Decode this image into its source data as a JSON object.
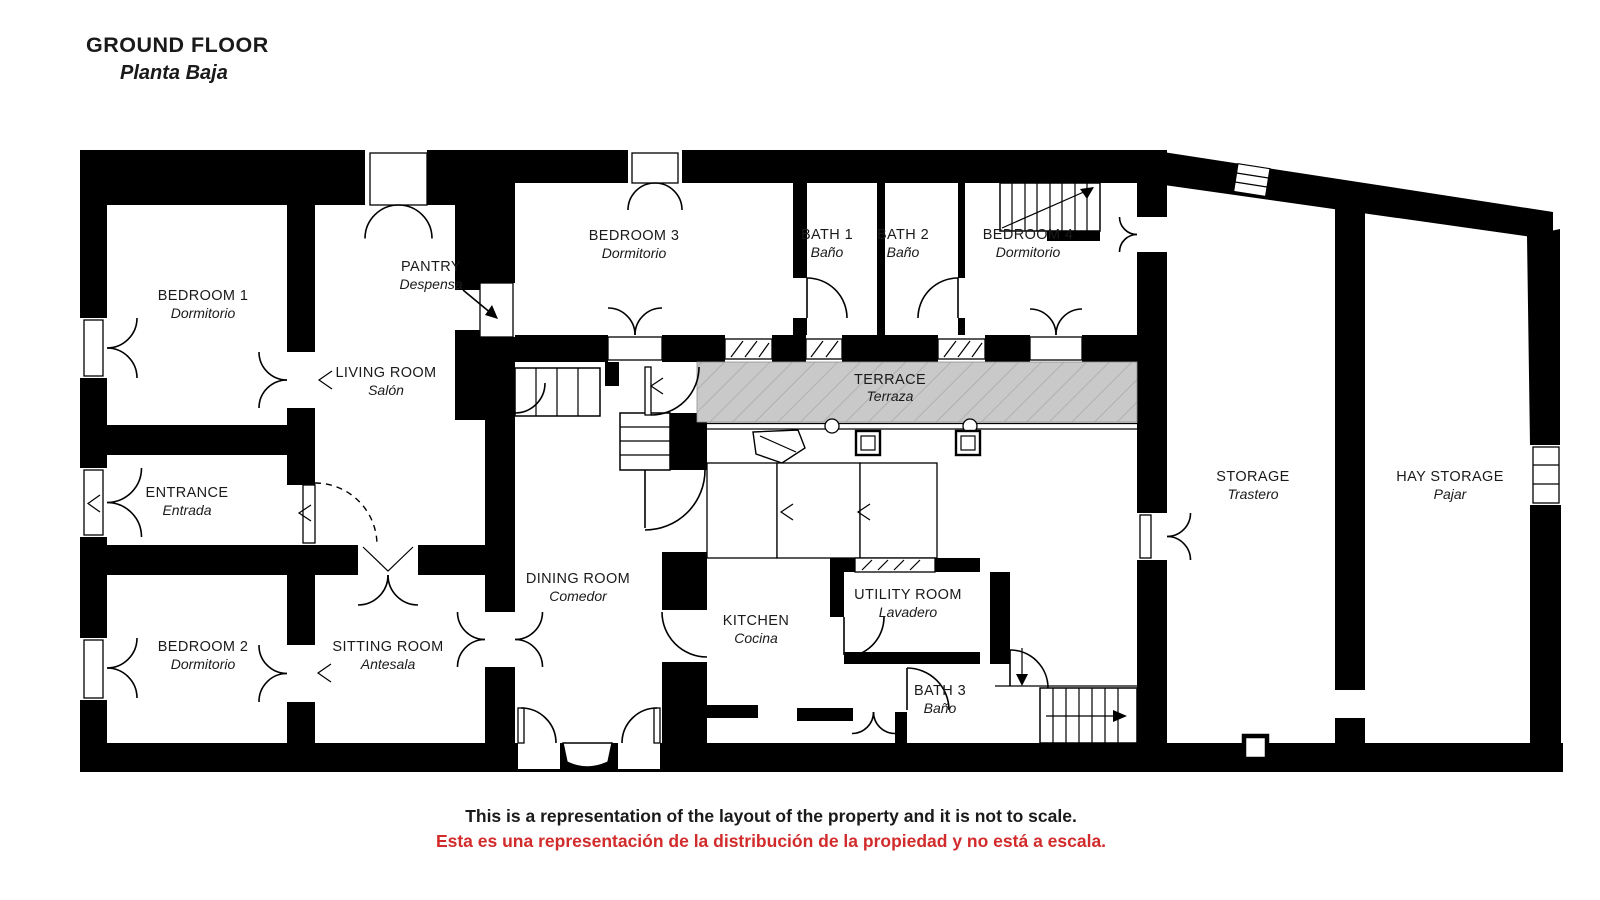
{
  "title": {
    "line1": "GROUND FLOOR",
    "line2": "Planta Baja"
  },
  "rooms": {
    "bedroom1": {
      "name": "BEDROOM 1",
      "alt": "Dormitorio"
    },
    "bedroom2": {
      "name": "BEDROOM 2",
      "alt": "Dormitorio"
    },
    "bedroom3": {
      "name": "BEDROOM 3",
      "alt": "Dormitorio"
    },
    "bedroom4": {
      "name": "BEDROOM 4",
      "alt": "Dormitorio"
    },
    "living": {
      "name": "LIVING ROOM",
      "alt": "Salón"
    },
    "pantry": {
      "name": "PANTRY",
      "alt": "Despensa"
    },
    "entrance": {
      "name": "ENTRANCE",
      "alt": "Entrada"
    },
    "sitting": {
      "name": "SITTING ROOM",
      "alt": "Antesala"
    },
    "dining": {
      "name": "DINING ROOM",
      "alt": "Comedor"
    },
    "kitchen": {
      "name": "KITCHEN",
      "alt": "Cocina"
    },
    "utility": {
      "name": "UTILITY ROOM",
      "alt": "Lavadero"
    },
    "bath1": {
      "name": "BATH 1",
      "alt": "Baño"
    },
    "bath2": {
      "name": "BATH 2",
      "alt": "Baño"
    },
    "bath3": {
      "name": "BATH 3",
      "alt": "Baño"
    },
    "terrace": {
      "name": "TERRACE",
      "alt": "Terraza"
    },
    "storage": {
      "name": "STORAGE",
      "alt": "Trastero"
    },
    "hay": {
      "name": "HAY STORAGE",
      "alt": "Pajar"
    }
  },
  "disclaimer": {
    "line1": "This is a representation of the layout of the property and it is not to scale.",
    "line2": "Esta es una representación de la distribución de la propiedad y no está a escala."
  },
  "colors": {
    "background": "#ffffff",
    "wall": "#000000",
    "terrace": "#c9c9c9",
    "terrace_hatch": "#a6a6a6",
    "text": "#1a1a1a",
    "disclaimer_red": "#d22b2b"
  }
}
